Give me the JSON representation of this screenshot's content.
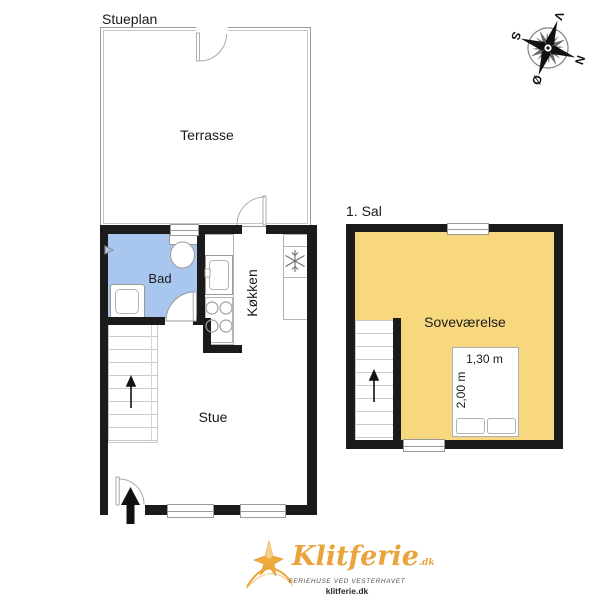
{
  "page": {
    "title_ground": "Stueplan",
    "title_first": "1. Sal"
  },
  "rooms": {
    "terrasse": "Terrasse",
    "bad": "Bad",
    "koekken": "Køkken",
    "stue": "Stue",
    "sovevaerelse": "Soveværelse"
  },
  "bed": {
    "width_label": "1,30 m",
    "length_label": "2,00 m"
  },
  "compass": {
    "north": "N",
    "south": "S",
    "east": "Ø",
    "west": "V"
  },
  "logo": {
    "brand": "Klitferie",
    "suffix": ".dk",
    "tagline": "FERIEHUSE VED VESTERHAVET",
    "website": "klitferie.dk"
  },
  "icons": {
    "fridge": "snowflake-icon",
    "stairs": "up-arrow-icon",
    "entrance": "entrance-arrow-icon",
    "toilet": "toilet-icon",
    "sink": "sink-icon",
    "stove": "stove-burners-icon",
    "compass": "compass-rose-icon"
  },
  "colors": {
    "wall": "#1b1b1b",
    "bathroom_fill": "#a9c7ee",
    "bedroom_fill": "#f8d87e",
    "logo_gold": "#e9a43c",
    "line_gray": "#9a9a9a"
  }
}
